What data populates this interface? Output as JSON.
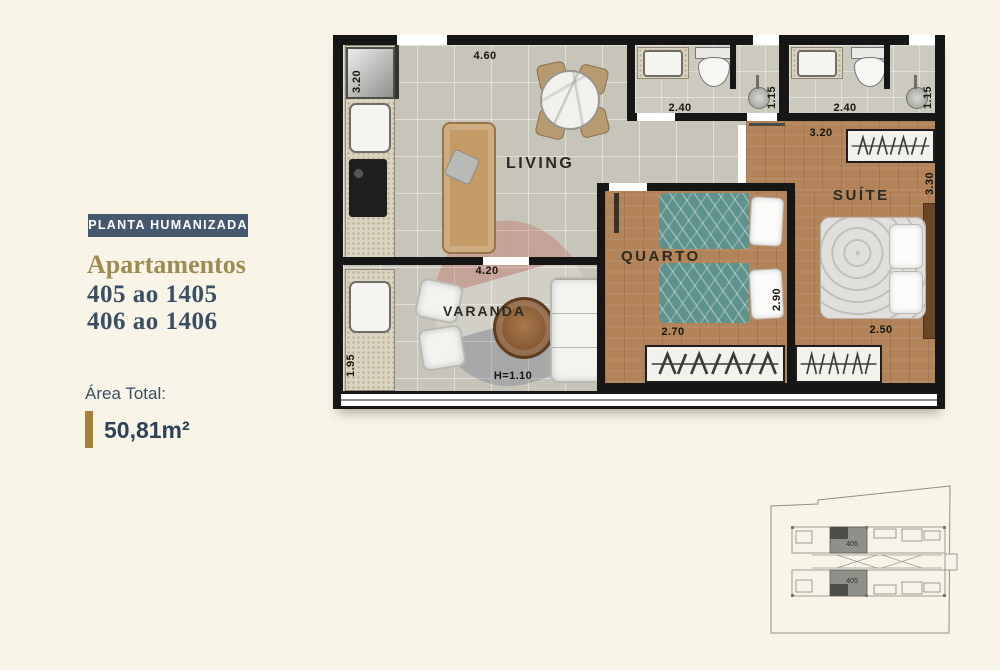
{
  "sidebar": {
    "tag": "PLANTA HUMANIZADA",
    "title": "Apartamentos",
    "line1": "405 ao 1405",
    "line2": "406 ao 1406",
    "area_label": "Área Total:",
    "area_value": "50,81m²"
  },
  "plan": {
    "rooms": {
      "living": "LIVING",
      "varanda": "VARANDA",
      "quarto": "QUARTO",
      "suite": "SUÍTE"
    },
    "dims": {
      "living_w": "4.60",
      "kitchen_d": "3.20",
      "service_d": "1.95",
      "varanda_w": "4.20",
      "varanda_rail": "H=1.10",
      "bath_w": "2.40",
      "bath_d": "1.15",
      "quarto_w": "2.70",
      "quarto_d": "2.90",
      "suite_w": "2.50",
      "suite_d": "3.30",
      "suite_wardrobe_w": "3.20"
    },
    "watermark_letter": "X"
  },
  "keyplan": {
    "unit_top": "406",
    "unit_bottom": "405"
  },
  "colors": {
    "navy": "#46586d",
    "navy_text": "#3b4f63",
    "gold_title": "#9c8c52",
    "gold_bar": "#a5813c",
    "background": "#f8f4e8"
  }
}
